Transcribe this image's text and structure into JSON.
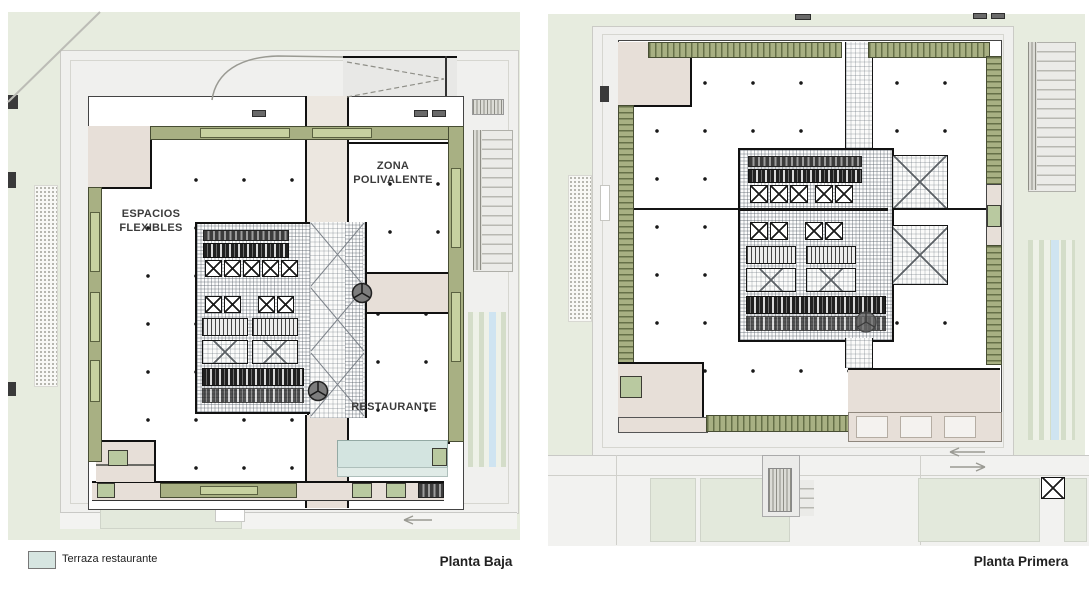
{
  "legend": {
    "label": "Terraza restaurante",
    "swatch_color": "#d6e5e1"
  },
  "plan_left": {
    "title": "Planta Baja",
    "labels": {
      "espacios_flexibles": "ESPACIOS\nFLEXIBLES",
      "zona_polivalente": "ZONA\nPOLIVALENTE",
      "restaurante": "RESTAURANTE"
    }
  },
  "plan_right": {
    "title": "Planta Primera"
  },
  "colors": {
    "site_green": "#e7ecdf",
    "plaza_grey": "#f0f0ee",
    "facade_olive": "#a8b083",
    "planter_green": "#c7d1a0",
    "room_beige": "#e7dfd8",
    "terrace_teal": "#d3e4e0",
    "water_blue": "#cfe4f1",
    "wall_black": "#151515"
  }
}
